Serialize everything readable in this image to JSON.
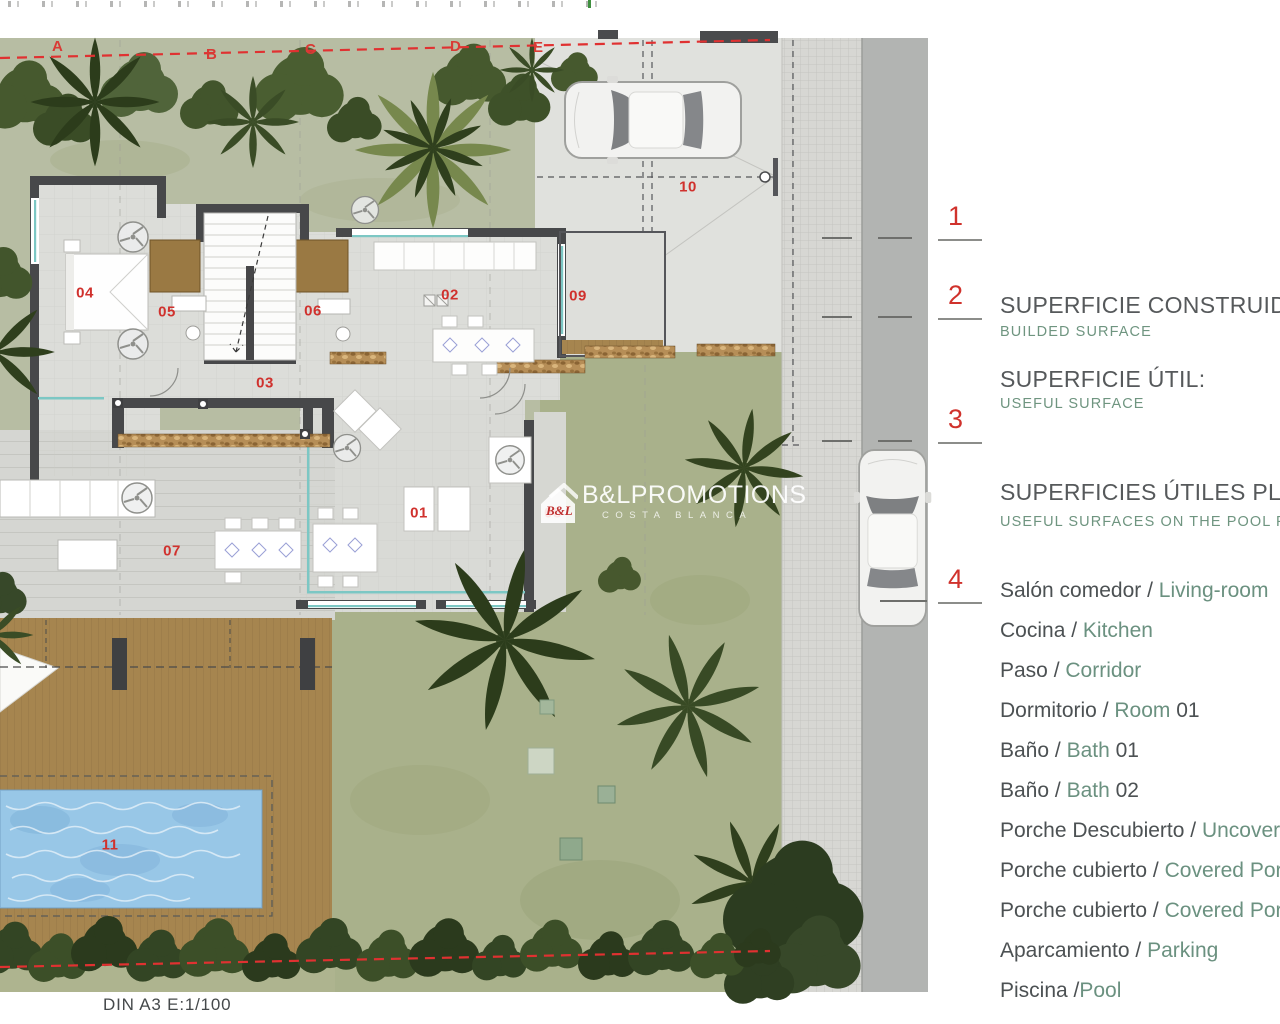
{
  "colors": {
    "label_red": "#d0312d",
    "boundary_red": "#e03131",
    "legend_green": "#6b9180",
    "heading_gray": "#56595b",
    "pool_blue": "#98c7e7",
    "deck_brown": "#a6854f",
    "lawn_green": "#a9b18b",
    "road_gray": "#b2b4b2",
    "wall_dark": "#47484a"
  },
  "plan": {
    "boundary_letters": [
      "A",
      "B",
      "C",
      "D",
      "E"
    ],
    "room_numbers": [
      "01",
      "02",
      "03",
      "04",
      "05",
      "06",
      "07",
      "08",
      "09",
      "10",
      "11"
    ],
    "margin_markers": [
      "1",
      "2",
      "3",
      "4"
    ]
  },
  "watermark": {
    "logo_text": "B&L",
    "title": "B&LPROMOTIONS",
    "subtitle": "COSTA BLANCA"
  },
  "legend": {
    "sections": [
      {
        "title": "SUPERFICIE CONSTRUIDA:",
        "subtitle": "BUILDED SURFACE"
      },
      {
        "title": "SUPERFICIE ÚTIL:",
        "subtitle": "USEFUL SURFACE"
      },
      {
        "title": "SUPERFICIES ÚTILES PLANTA",
        "subtitle": "USEFUL SURFACES ON THE POOL FLOOR"
      }
    ],
    "rooms": [
      {
        "es": "Salón comedor",
        "sep": " / ",
        "en": "Living-room",
        "num": ""
      },
      {
        "es": "Cocina",
        "sep": " / ",
        "en": "Kitchen",
        "num": ""
      },
      {
        "es": "Paso",
        "sep": " / ",
        "en": "Corridor",
        "num": ""
      },
      {
        "es": "Dormitorio",
        "sep": " / ",
        "en": "Room",
        "num": " 01"
      },
      {
        "es": "Baño",
        "sep": " / ",
        "en": "Bath",
        "num": " 01"
      },
      {
        "es": "Baño",
        "sep": " / ",
        "en": "Bath",
        "num": " 02"
      },
      {
        "es": "Porche Descubierto",
        "sep": " / ",
        "en": "Uncovered Porch",
        "num": ""
      },
      {
        "es": "Porche cubierto",
        "sep": " / ",
        "en": "Covered Porch",
        "num": ""
      },
      {
        "es": "Porche cubierto",
        "sep": " / ",
        "en": "Covered Porch",
        "num": ""
      },
      {
        "es": "Aparcamiento",
        "sep": " / ",
        "en": "Parking",
        "num": ""
      },
      {
        "es": "Piscina",
        "sep": " /",
        "en": "Pool",
        "num": ""
      }
    ]
  },
  "footer": {
    "scale_label": "DIN A3  E:1/100"
  }
}
